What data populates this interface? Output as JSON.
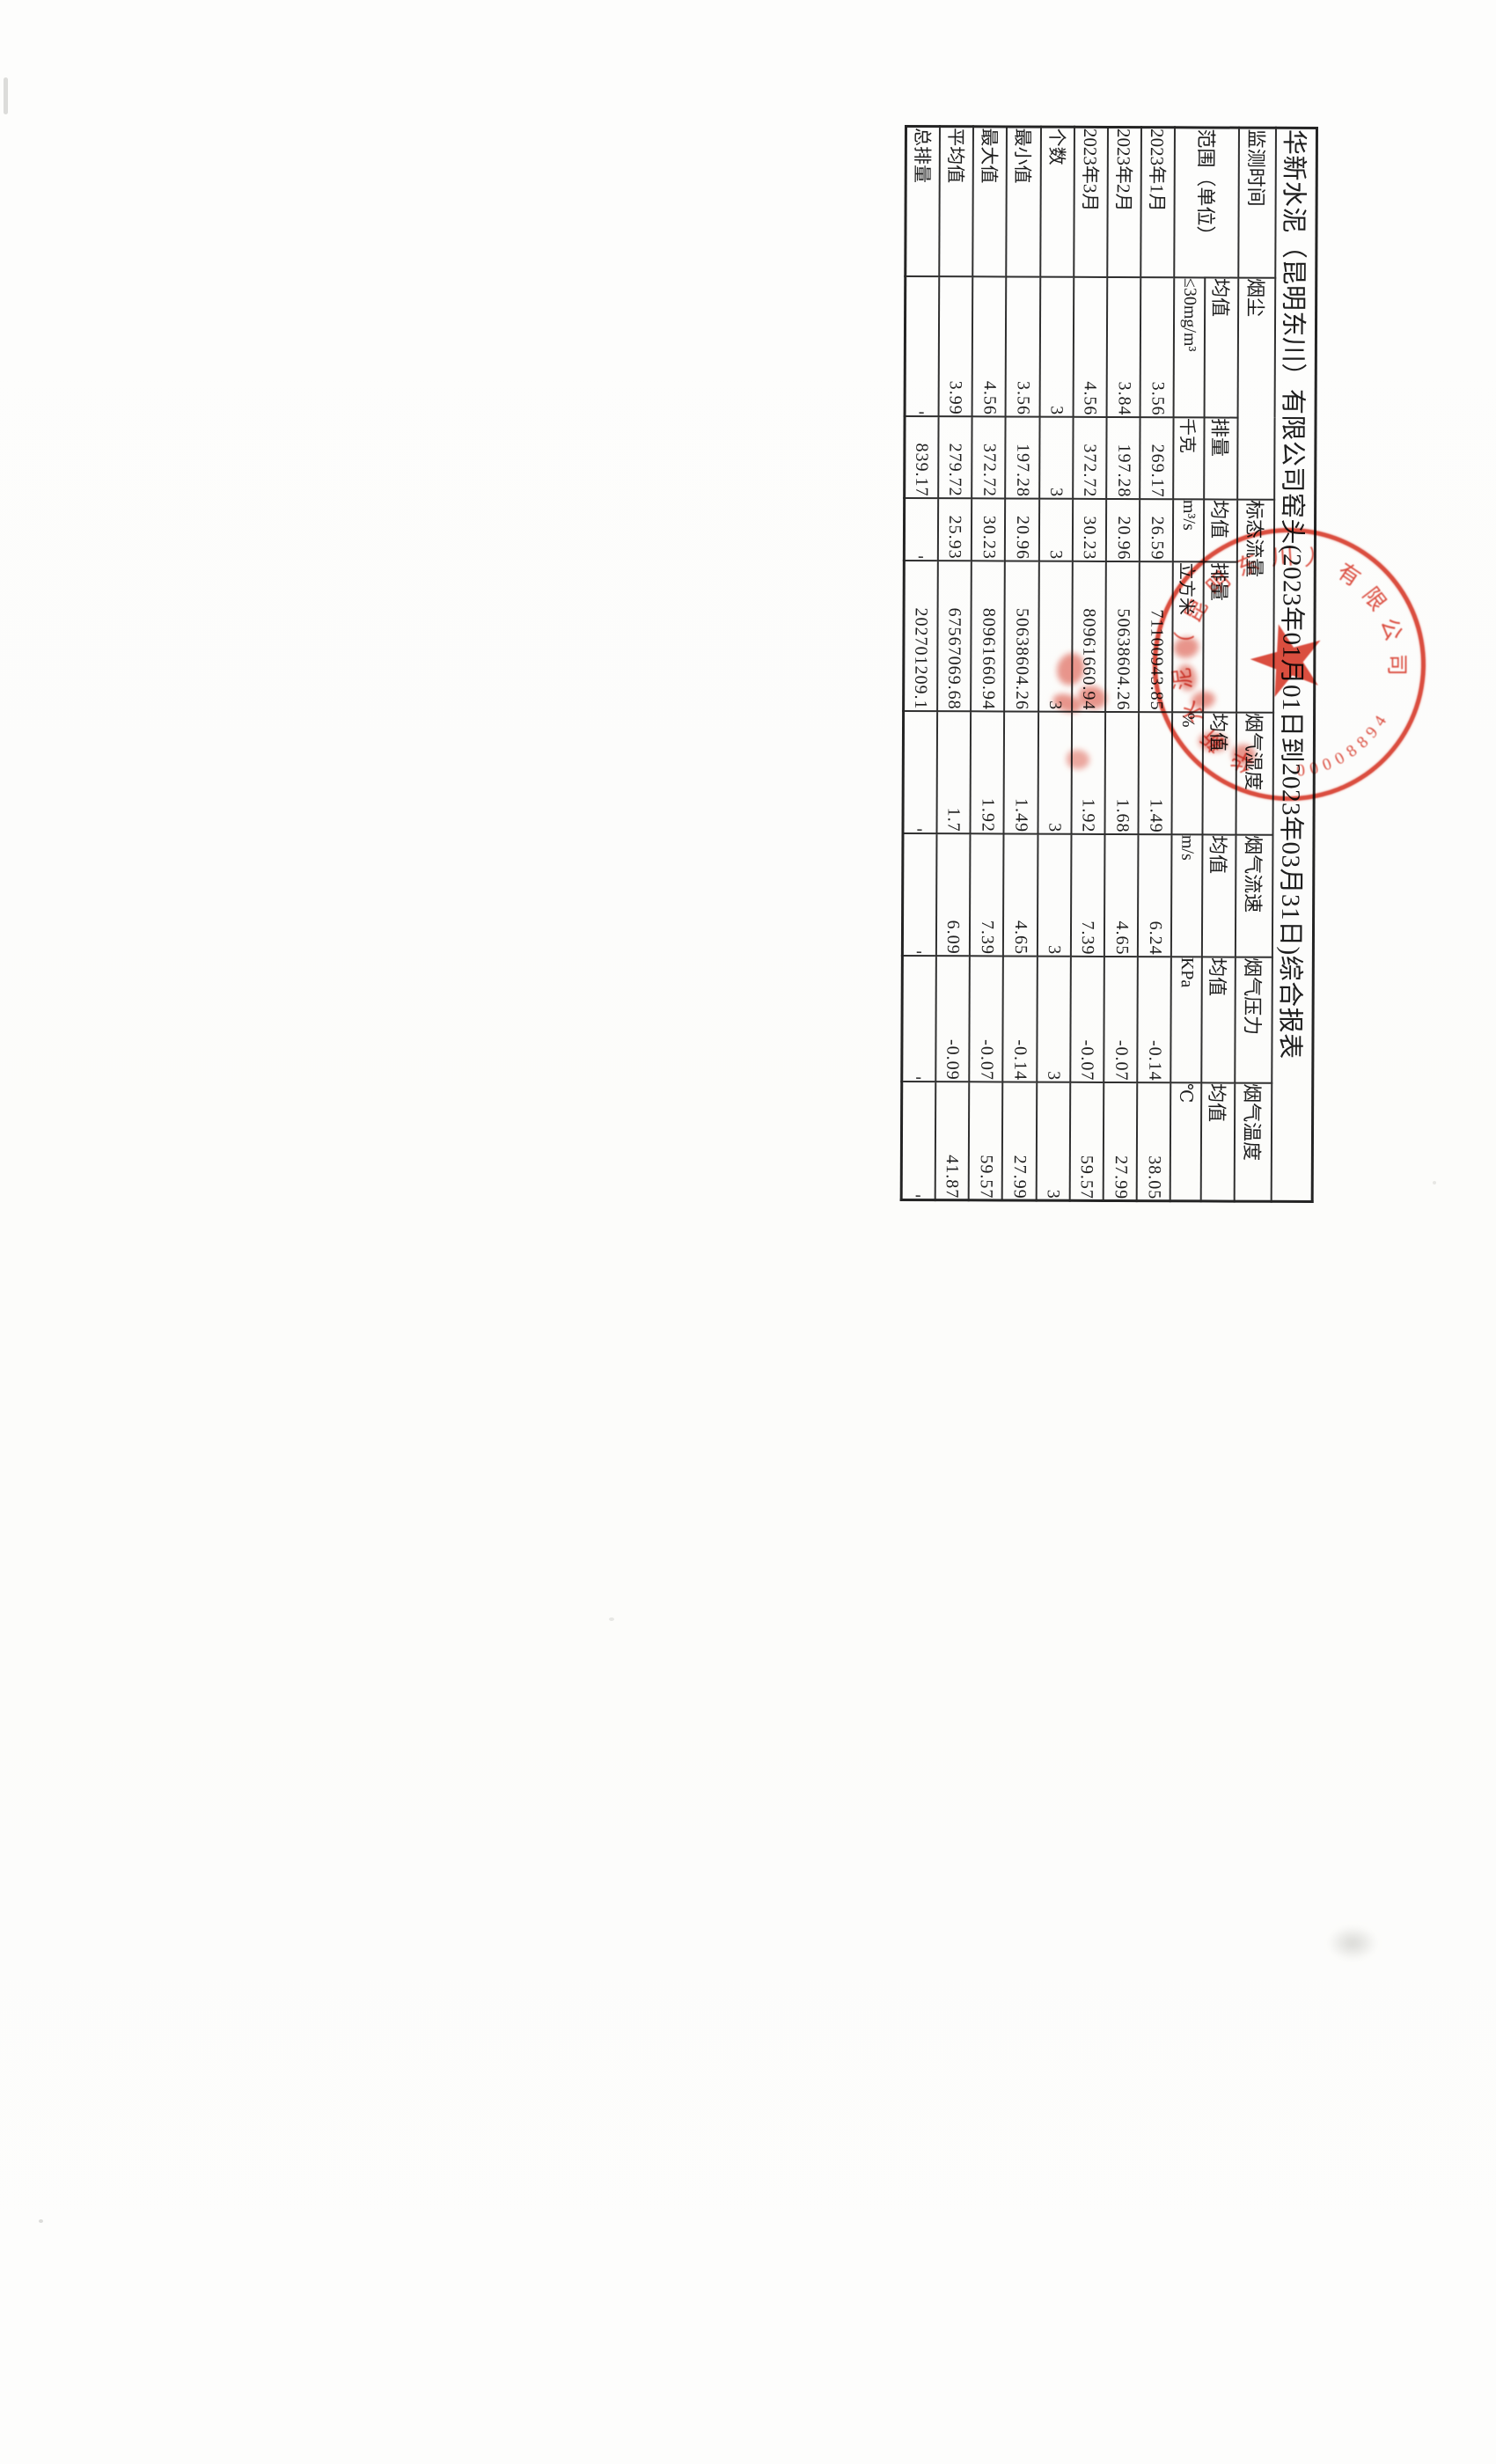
{
  "document": {
    "title": "华新水泥（昆明东川）有限公司窑头(2023年01月01日到2023年03月31日)综合报表",
    "table": {
      "header": {
        "time_label": "监测时间",
        "range_label": "范围（单位）",
        "groups": [
          {
            "label": "烟尘",
            "sub": [
              {
                "label": "均值",
                "unit": "≤30mg/m³"
              },
              {
                "label": "排量",
                "unit": "千克"
              }
            ]
          },
          {
            "label": "标态流量",
            "sub": [
              {
                "label": "均值",
                "unit": "m³/s"
              },
              {
                "label": "排量",
                "unit": "立方米"
              }
            ]
          },
          {
            "label": "烟气湿度",
            "sub": [
              {
                "label": "均值",
                "unit": "%"
              }
            ]
          },
          {
            "label": "烟气流速",
            "sub": [
              {
                "label": "均值",
                "unit": "m/s"
              }
            ]
          },
          {
            "label": "烟气压力",
            "sub": [
              {
                "label": "均值",
                "unit": "KPa"
              }
            ]
          },
          {
            "label": "烟气温度",
            "sub": [
              {
                "label": "均值",
                "unit": "℃"
              }
            ]
          }
        ]
      },
      "rows": [
        {
          "label": "2023年1月",
          "values": [
            "3.56",
            "269.17",
            "26.59",
            "71100943.85",
            "1.49",
            "6.24",
            "-0.14",
            "38.05"
          ]
        },
        {
          "label": "2023年2月",
          "values": [
            "3.84",
            "197.28",
            "20.96",
            "50638604.26",
            "1.68",
            "4.65",
            "-0.07",
            "27.99"
          ]
        },
        {
          "label": "2023年3月",
          "values": [
            "4.56",
            "372.72",
            "30.23",
            "80961660.94",
            "1.92",
            "7.39",
            "-0.07",
            "59.57"
          ]
        },
        {
          "label": "个数",
          "values": [
            "3",
            "3",
            "3",
            "3",
            "3",
            "3",
            "3",
            "3"
          ]
        },
        {
          "label": "最小值",
          "values": [
            "3.56",
            "197.28",
            "20.96",
            "50638604.26",
            "1.49",
            "4.65",
            "-0.14",
            "27.99"
          ]
        },
        {
          "label": "最大值",
          "values": [
            "4.56",
            "372.72",
            "30.23",
            "80961660.94",
            "1.92",
            "7.39",
            "-0.07",
            "59.57"
          ]
        },
        {
          "label": "平均值",
          "values": [
            "3.99",
            "279.72",
            "25.93",
            "67567069.68",
            "1.7",
            "6.09",
            "-0.09",
            "41.87"
          ]
        },
        {
          "label": "总排量",
          "values": [
            "-",
            "839.17",
            "-",
            "202701209.1",
            "-",
            "-",
            "-",
            "-"
          ]
        }
      ],
      "no_data_mark": "-"
    },
    "stamp": {
      "company": "华新水泥（昆明东川）有限公司",
      "serial": "00008894",
      "color": "#d93a2b"
    }
  }
}
